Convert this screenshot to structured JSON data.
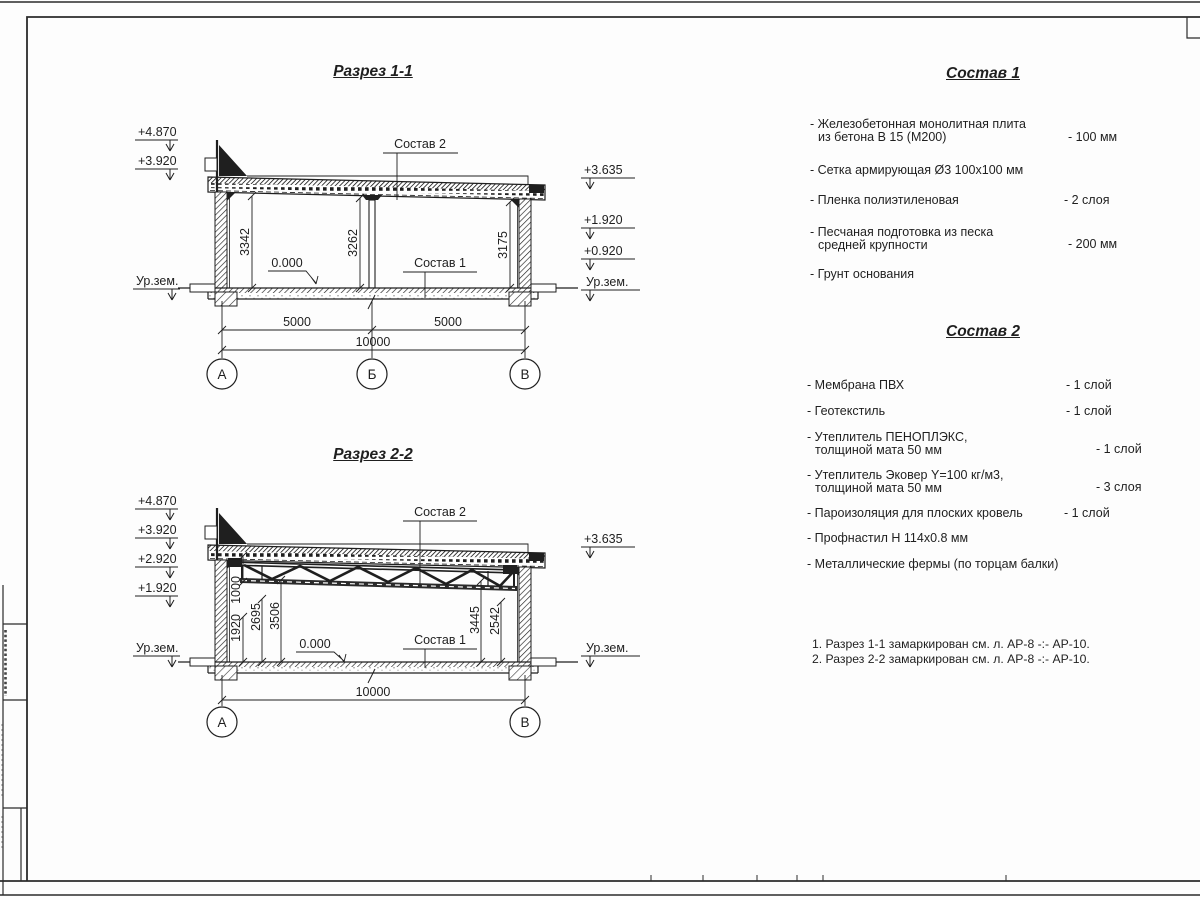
{
  "section1": {
    "title": "Разрез 1-1",
    "elevations_left": [
      "+4.870",
      "+3.920"
    ],
    "ground_left": "Ур.зем.",
    "elevations_right": [
      "+3.635",
      "+1.920",
      "+0.920"
    ],
    "ground_right": "Ур.зем.",
    "height_dims": [
      "3342",
      "3262",
      "3175"
    ],
    "zero_level": "0.000",
    "callout_top": "Состав 2",
    "callout_floor": "Состав 1",
    "span_dims": [
      "5000",
      "5000"
    ],
    "total_dim": "10000",
    "axis_labels": [
      "А",
      "Б",
      "В"
    ]
  },
  "section2": {
    "title": "Разрез 2-2",
    "elevations_left": [
      "+4.870",
      "+3.920",
      "+2.920",
      "+1.920"
    ],
    "ground_left": "Ур.зем.",
    "elevations_right": [
      "+3.635"
    ],
    "ground_right": "Ур.зем.",
    "height_dims_left": [
      "1000",
      "1920",
      "2695",
      "3506"
    ],
    "height_dims_right": [
      "3445",
      "2542"
    ],
    "zero_level": "0.000",
    "callout_top": "Состав 2",
    "callout_floor": "Состав 1",
    "total_dim": "10000",
    "axis_labels": [
      "А",
      "В"
    ]
  },
  "sostav1": {
    "title": "Состав 1",
    "items": [
      {
        "line1": "- Железобетонная  монолитная плита",
        "line2": "из бетона В 15 (М200)",
        "value": "- 100 мм"
      },
      {
        "line1": "- Сетка армирующая Ø3 100х100 мм",
        "line2": "",
        "value": ""
      },
      {
        "line1": "- Пленка полиэтиленовая",
        "line2": "",
        "value": "-  2 слоя"
      },
      {
        "line1": "- Песчаная подготовка из песка",
        "line2": "средней крупности",
        "value": "- 200 мм"
      },
      {
        "line1": "- Грунт основания",
        "line2": "",
        "value": ""
      }
    ]
  },
  "sostav2": {
    "title": "Состав 2",
    "items": [
      {
        "line1": "- Мембрана ПВХ",
        "line2": "",
        "value": "- 1 слой"
      },
      {
        "line1": "- Геотекстиль",
        "line2": "",
        "value": "- 1 слой"
      },
      {
        "line1": "- Утеплитель ПЕНОПЛЭКС,",
        "line2": "толщиной мата 50 мм",
        "value": "- 1 слой"
      },
      {
        "line1": "- Утеплитель Эковер Y=100 кг/м3,",
        "line2": "толщиной мата 50 мм",
        "value": "- 3 слоя"
      },
      {
        "line1": "- Пароизоляция для плоских кровель",
        "line2": "",
        "value": "- 1 слой"
      },
      {
        "line1": "- Профнастил Н 114х0.8 мм",
        "line2": "",
        "value": ""
      },
      {
        "line1": "- Металлические фермы (по торцам балки)",
        "line2": "",
        "value": ""
      }
    ]
  },
  "notes": {
    "n1": "1. Разрез 1-1 замаркирован см. л. АР-8 -:- АР-10.",
    "n2": "2. Разрез 2-2 замаркирован см. л. АР-8 -:- АР-10."
  },
  "colors": {
    "line": "#1f1f1f",
    "paper": "#fdfdfd"
  }
}
